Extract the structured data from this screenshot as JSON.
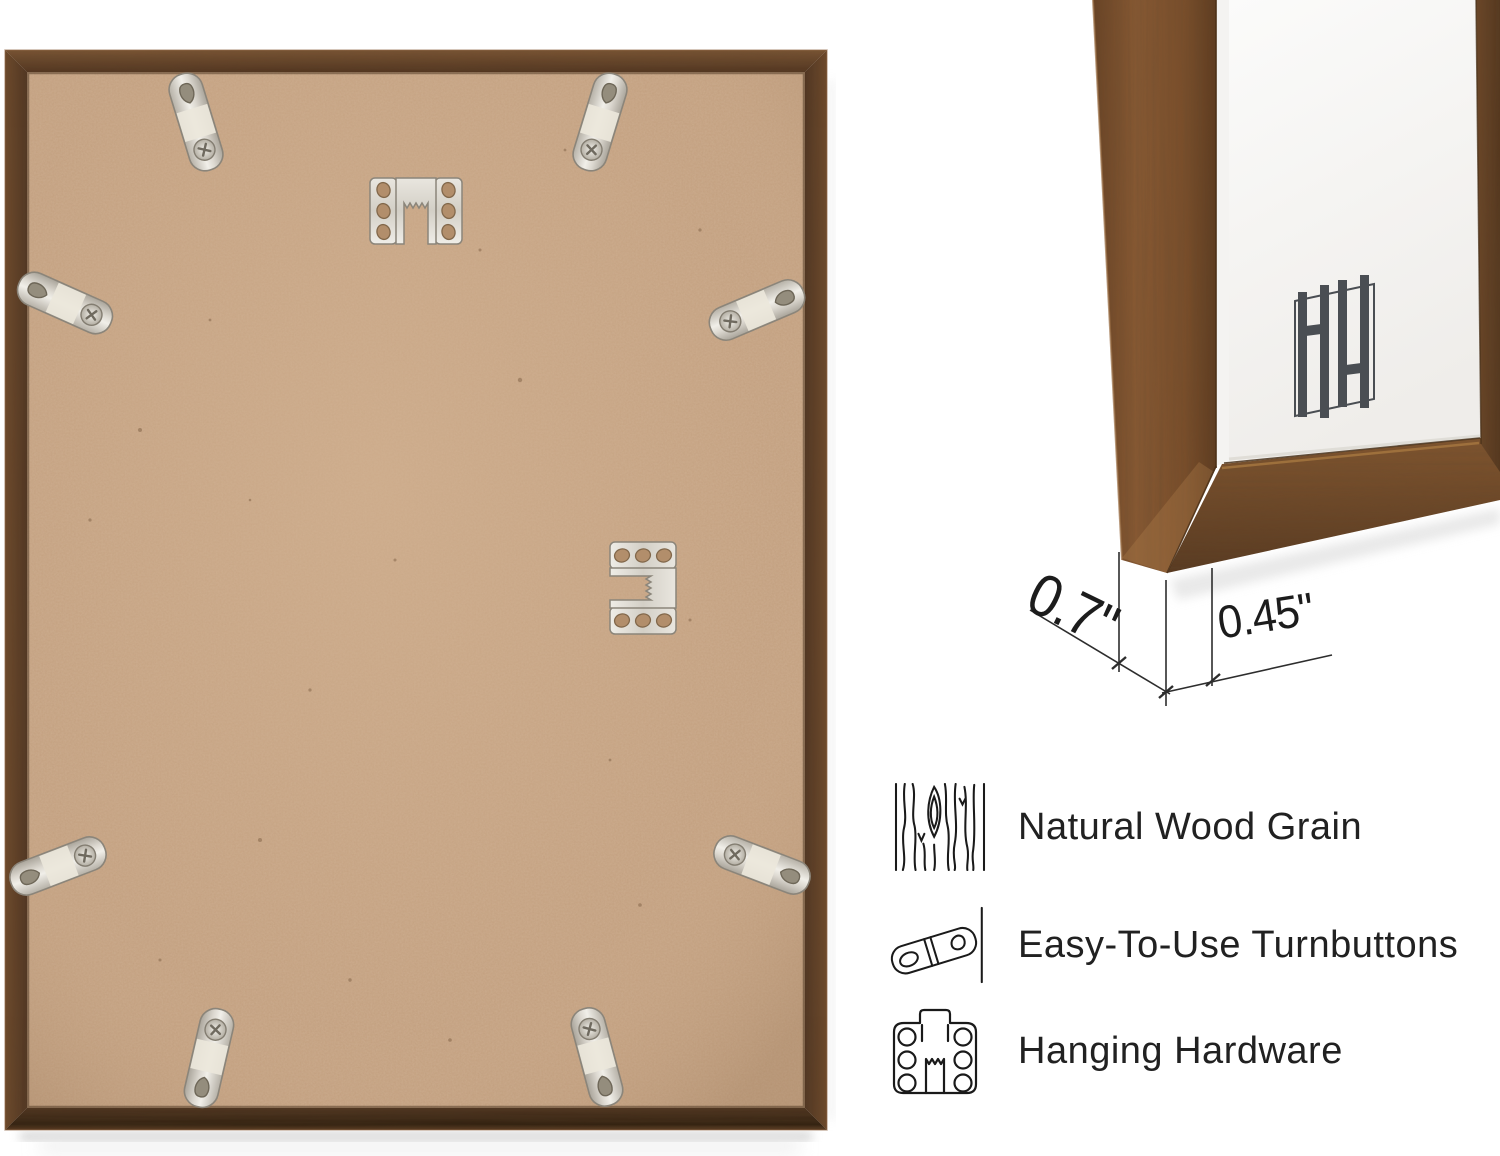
{
  "dimension_callout": {
    "depth_label": "0.7\"",
    "face_width_label": "0.45\""
  },
  "features": [
    {
      "icon": "wood-grain-icon",
      "label": "Natural Wood Grain"
    },
    {
      "icon": "turnbutton-icon",
      "label": "Easy-To-Use Turnbuttons"
    },
    {
      "icon": "hanging-hardware-icon",
      "label": "Hanging Hardware"
    }
  ],
  "brand_logo": {
    "letters": "HH"
  },
  "hardware": {
    "turnbutton_count": 8,
    "sawtooth_hanger_count": 2
  },
  "colors": {
    "background": "#ffffff",
    "frame_wood_dark": "#553720",
    "frame_wood_mid": "#6b4628",
    "frame_wood_light": "#8a5a33",
    "backing_board": "#c6a282",
    "metal_hardware": "#ddd9d1",
    "logo_gray": "#4a4e53",
    "text_dark": "#1c1c1c",
    "icon_stroke": "#1a1a1a"
  }
}
